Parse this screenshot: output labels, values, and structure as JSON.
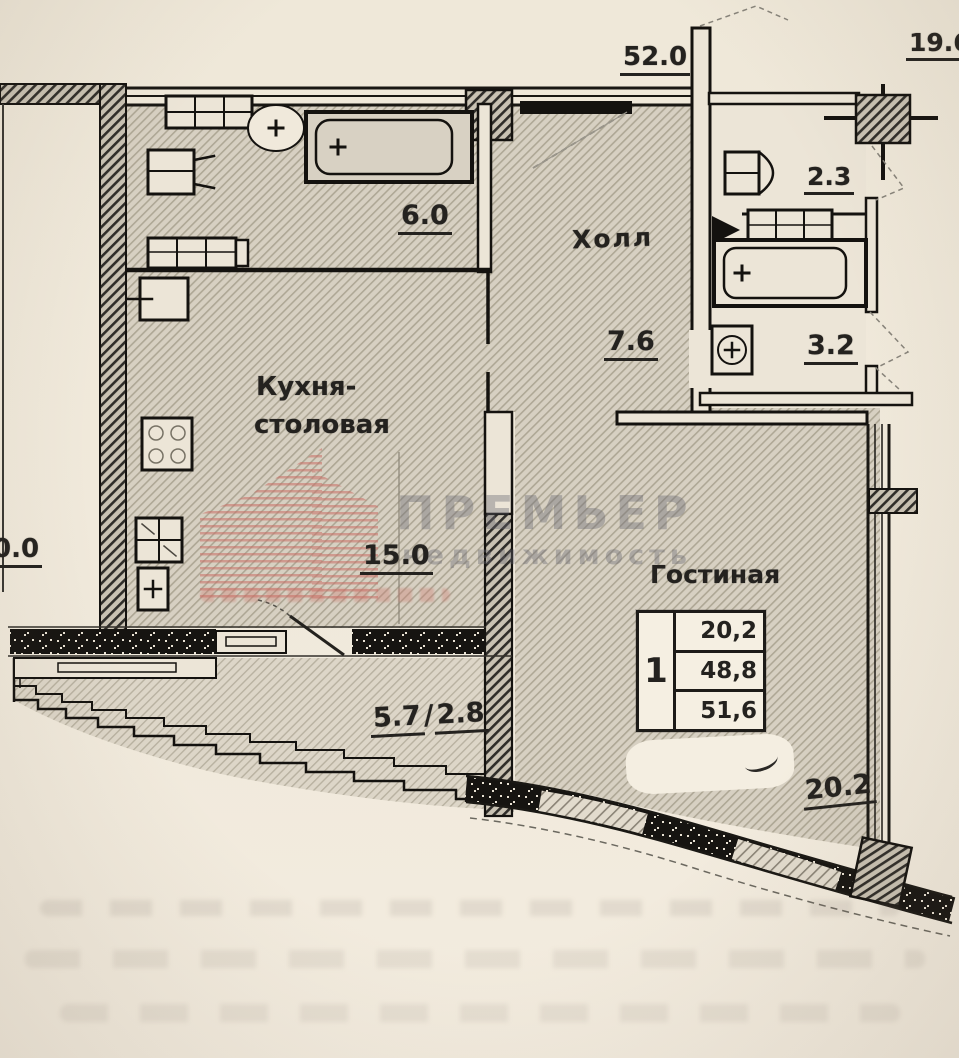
{
  "watermark": {
    "line1": "ПРЕМЬЕР",
    "line2": "недвижимость"
  },
  "dimensions": {
    "top_center": "52.0",
    "top_right": "19.6",
    "left_partial": "0.0"
  },
  "rooms": {
    "kitchen": {
      "name_line1": "Кухня-",
      "name_line2": "столовая",
      "area": "15.0"
    },
    "hall": {
      "name": "Холл",
      "area": "7.6"
    },
    "living": {
      "name": "Гостиная",
      "area": "20.2"
    },
    "bathroom": {
      "area": "6.0"
    },
    "wc_top": {
      "area": "2.3"
    },
    "wc_bottom": {
      "area": "3.2"
    },
    "balcony": {
      "area_full": "5.7",
      "separator": "/",
      "area_reduced": "2.8"
    }
  },
  "summary_table": {
    "rooms_count": "1",
    "living_area": "20,2",
    "total_area": "48,8",
    "total_with_balcony": "51,6"
  },
  "colors": {
    "paper": "#efe8da",
    "floor": "#d7d0c2",
    "ink": "#1d1b18",
    "logo_red": "#c96f66",
    "watermark_gray": "#64646e"
  }
}
